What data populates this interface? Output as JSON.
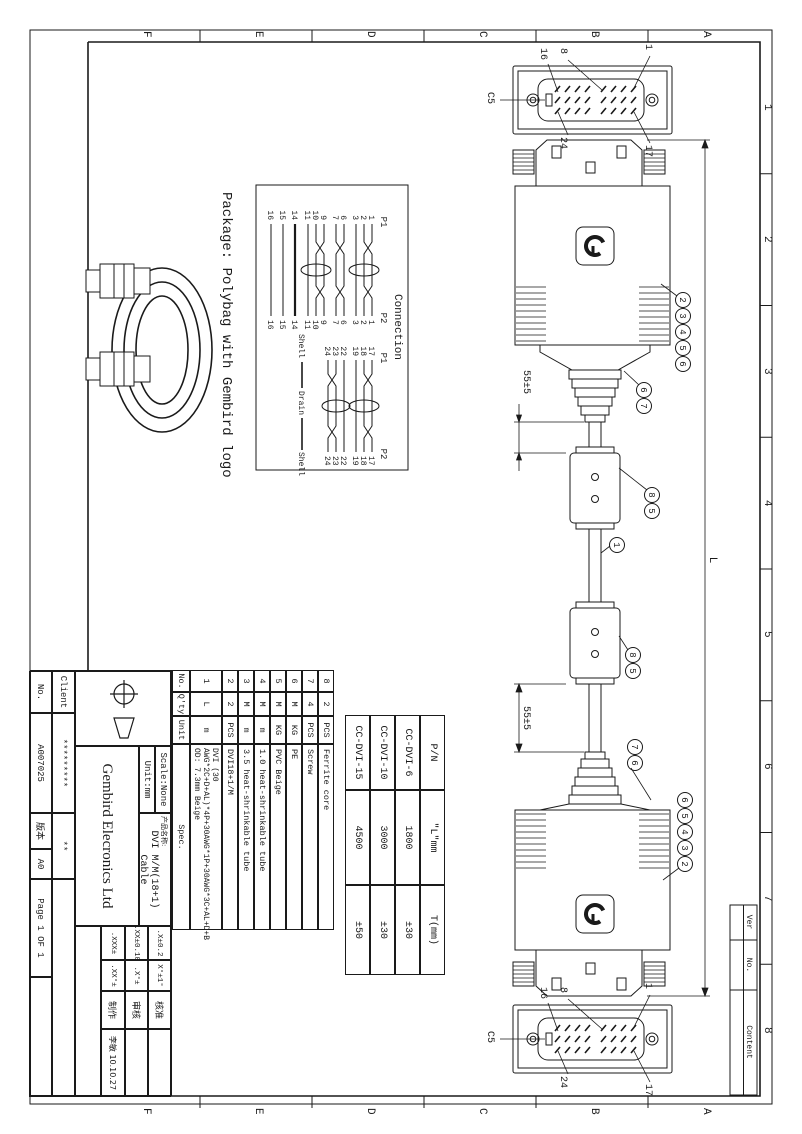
{
  "drawing": {
    "package_text": "Package: Polybag with Gembird logo",
    "dim_55_left": "55±5",
    "dim_55_right": "55±5",
    "dim_length": "L"
  },
  "zones": {
    "letters": [
      "A",
      "B",
      "C",
      "D",
      "E",
      "F"
    ],
    "numbers": [
      "1",
      "2",
      "3",
      "4",
      "5",
      "6",
      "7",
      "8"
    ]
  },
  "revision": {
    "ver_label": "Ver",
    "no_label": "No.",
    "content_label": "Content"
  },
  "connector_face": {
    "c5": "C5",
    "pin1": "1",
    "pin8": "8",
    "pin16": "16",
    "pin17": "17",
    "pin24": "24"
  },
  "callouts": {
    "row_left": [
      "2",
      "3",
      "4",
      "5",
      "6"
    ],
    "screw_pair_left": [
      "6",
      "7"
    ],
    "ferrite_pair_left": [
      "8",
      "5"
    ],
    "cable": "1",
    "ferrite_pair_right": [
      "8",
      "5"
    ],
    "screw_pair_right": [
      "7",
      "6"
    ],
    "row_right": [
      "6",
      "5",
      "4",
      "3",
      "2"
    ]
  },
  "connection": {
    "title": "Connection",
    "p1": "P1",
    "p2": "P2",
    "shell": "Shell",
    "drain": "Drain",
    "group1_pins": [
      "1",
      "2",
      "3",
      "6",
      "7",
      "9",
      "10",
      "11",
      "14",
      "15",
      "16"
    ],
    "group2_pins": [
      "17",
      "18",
      "19",
      "22",
      "23",
      "24"
    ]
  },
  "pn_table": {
    "col_pn": "P/N",
    "col_l": "\"L\"mm",
    "col_t": "T(mm)",
    "rows": [
      {
        "pn": "CC-DVI-6",
        "l": "1800",
        "t": "±30"
      },
      {
        "pn": "CC-DVI-10",
        "l": "3000",
        "t": "±30"
      },
      {
        "pn": "CC-DVI-15",
        "l": "4500",
        "t": "±50"
      }
    ]
  },
  "bom": {
    "no_label": "No.",
    "qty_label": "Q'ty",
    "unit_label": "Unit",
    "spec_label": "Spec.",
    "rows": [
      {
        "no": "8",
        "qty": "2",
        "unit": "PCS",
        "spec": "Ferrite core"
      },
      {
        "no": "7",
        "qty": "4",
        "unit": "PCS",
        "spec": "Screw"
      },
      {
        "no": "6",
        "qty": "M",
        "unit": "KG",
        "spec": "PE"
      },
      {
        "no": "5",
        "qty": "M",
        "unit": "KG",
        "spec": "PVC Beige"
      },
      {
        "no": "4",
        "qty": "M",
        "unit": "m",
        "spec": "1.0 heat-shrinkable tube"
      },
      {
        "no": "3",
        "qty": "M",
        "unit": "m",
        "spec": "3.5 heat-shrinkable tube"
      },
      {
        "no": "2",
        "qty": "2",
        "unit": "PCS",
        "spec": "DVI18+1/M"
      },
      {
        "no": "1",
        "qty": "L",
        "unit": "m",
        "spec": "DVI (30 AWG*2C+D+AL)*4P+30AWG*1P+30AWG*3C+AL+D+B OD: 7.3mm Beige"
      }
    ]
  },
  "title_block": {
    "company": "Gembird Elecronics Ltd",
    "scale_label": "Scale:None",
    "unit_label": "Unit:mm",
    "product_label": "产品名称:",
    "product_name": "DVI M/M(18+1) Cable",
    "client_label": "Client",
    "client_value": "*********",
    "no_label": "No.",
    "drawing_no": "A007025",
    "version_label": "版本",
    "version": "A0",
    "page": "Page 1 OF 1",
    "stars": "**",
    "tol_r1c1": ".X±0.2",
    "tol_r1c2": "X°±1°",
    "tol_r2c1": ".XX±0.10",
    "tol_r2c2": ".X°±",
    "tol_r3c1": ".XXX±",
    "tol_r3c2": ".XX°±",
    "approve_label": "核准",
    "review_label": "审核",
    "make_label": "制作",
    "maker": "李敏 10.10.27"
  }
}
